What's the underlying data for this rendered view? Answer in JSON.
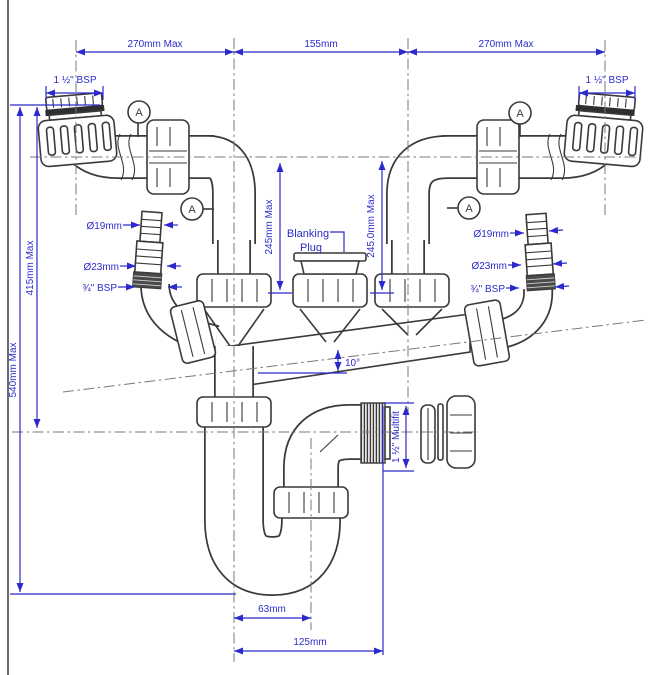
{
  "colors": {
    "dimension_blue": "#2b2bcb",
    "linework": "#3a3a3a",
    "background": "#ffffff"
  },
  "dims": {
    "top_left": "270mm Max",
    "top_center": "155mm",
    "top_right": "270mm Max",
    "bsp_left": "1 ½\" BSP",
    "bsp_right": "1 ½\" BSP",
    "h540": "540mm Max",
    "h415": "415mm Max",
    "d245l": "245mm Max",
    "d245r": "245.0mm Max",
    "angle": "10°",
    "multifit": "1 ½\" Multifit",
    "w63": "63mm",
    "w125": "125mm"
  },
  "hose_left": {
    "d19": "Ø19mm",
    "d23": "Ø23mm",
    "bsp": "¾\" BSP"
  },
  "hose_right": {
    "d19": "Ø19mm",
    "d23": "Ø23mm",
    "bsp": "¾\" BSP"
  },
  "labels": {
    "blanking1": "Blanking",
    "blanking2": "Plug",
    "marker": "A"
  }
}
